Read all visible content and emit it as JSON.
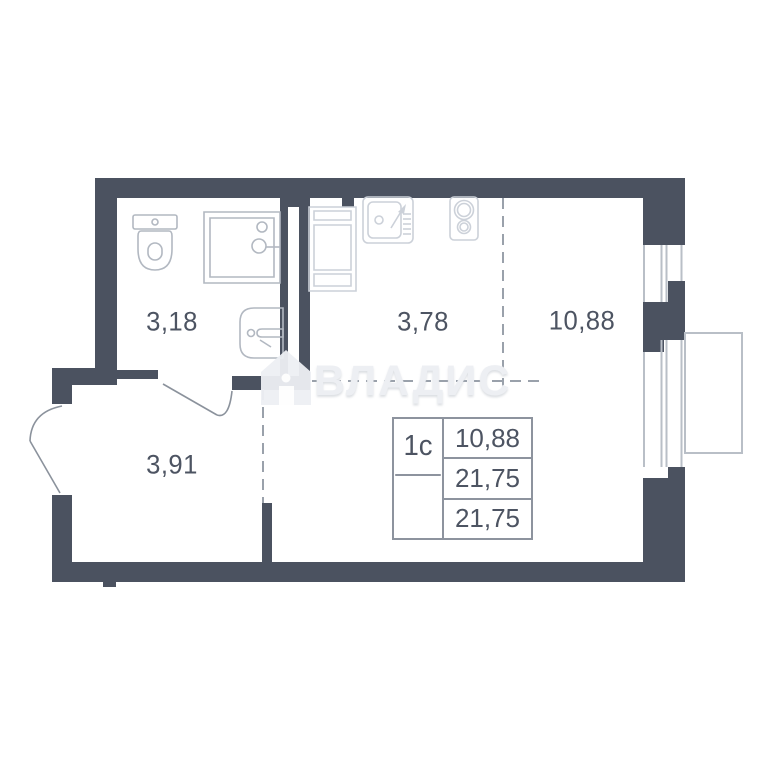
{
  "plan": {
    "title": "studio apartment floor plan",
    "watermark": {
      "text": "ВЛАДИС",
      "logo": "house-logo"
    },
    "rooms": [
      {
        "id": "bathroom",
        "area": "3,18"
      },
      {
        "id": "kitchen",
        "area": "3,78"
      },
      {
        "id": "living-room",
        "area": "10,88"
      },
      {
        "id": "hallway",
        "area": "3,91"
      }
    ],
    "info_table": {
      "type_label": "1с",
      "values": [
        "10,88",
        "21,75",
        "21,75"
      ]
    },
    "fixtures": [
      "toilet",
      "shower",
      "bathroom-sink",
      "kitchen-cabinet",
      "kitchen-sink",
      "stove"
    ],
    "colors": {
      "wall": "#4b5260",
      "fixture": "#b2b8c1",
      "fixture_light": "#ccd1d9",
      "text": "#4d5462",
      "dashed": "#9aa1ab",
      "table_border": "#8d939e",
      "watermark": "#edeff3",
      "window": "#b9bfc7",
      "door": "#8b929c"
    }
  }
}
